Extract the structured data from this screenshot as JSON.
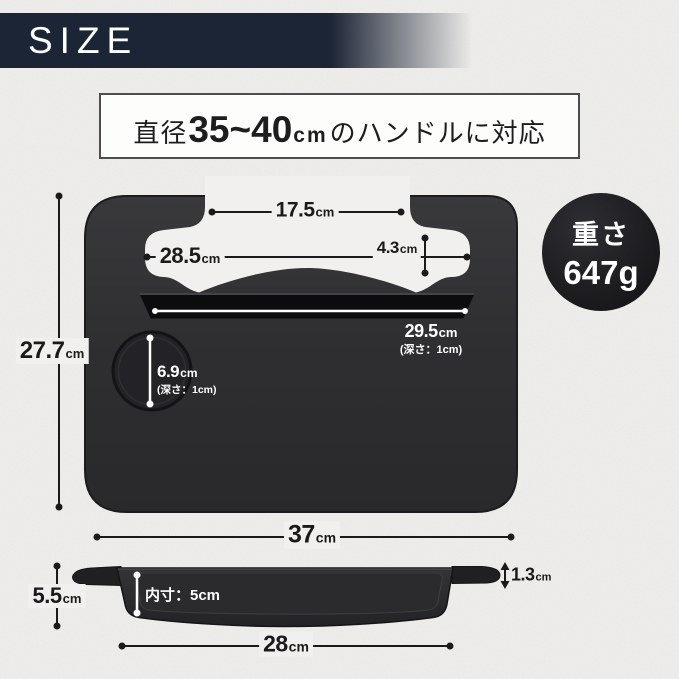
{
  "header": {
    "title": "SIZE"
  },
  "headline": {
    "prefix": "直径",
    "range": "35~40",
    "unit": "cm",
    "suffix": "のハンドルに対応"
  },
  "weight_badge": {
    "label": "重さ",
    "value": "647g"
  },
  "top_view": {
    "hook_span": {
      "value": "17.5",
      "unit": "cm"
    },
    "inner_span": {
      "value": "28.5",
      "unit": "cm"
    },
    "hook_opening": {
      "value": "4.3",
      "unit": "cm"
    },
    "body_height": {
      "value": "27.7",
      "unit": "cm"
    },
    "pen_tray": {
      "value": "29.5",
      "unit": "cm",
      "note": "(深さ：1cm)"
    },
    "cup_holder": {
      "value": "6.9",
      "unit": "cm",
      "note": "(深さ：1cm)"
    },
    "total_width": {
      "value": "37",
      "unit": "cm"
    }
  },
  "side_view": {
    "height": {
      "value": "5.5",
      "unit": "cm"
    },
    "inner_depth": "内寸：5cm",
    "lip_thickness": {
      "value": "1.3",
      "unit": "cm"
    },
    "bottom_width": {
      "value": "28",
      "unit": "cm"
    }
  },
  "colors": {
    "banner": "#1c2535",
    "background": "#f1f0ee",
    "tray": "#2e2e31",
    "badge": "#1b1b1e",
    "measure_line": "#1a1a1a",
    "measure_line_light": "#ffffff"
  }
}
